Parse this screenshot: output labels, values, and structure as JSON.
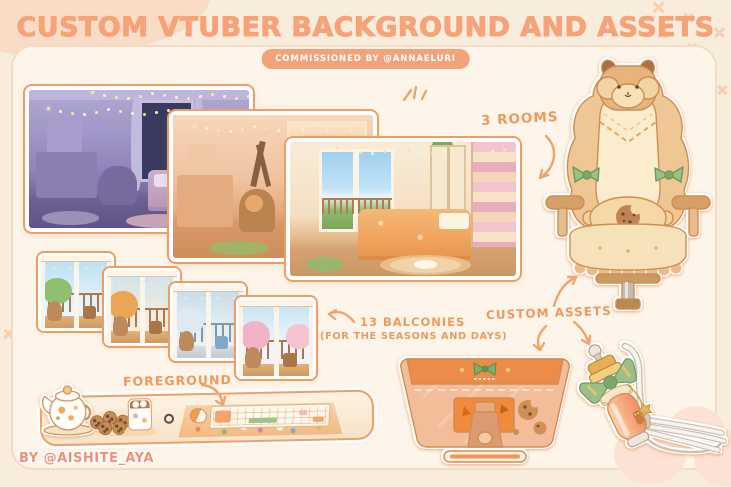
{
  "header": {
    "title": "CUSTOM VTUBER BACKGROUND AND ASSETS",
    "badge": "COMMISSIONED BY @ANNAELURI"
  },
  "labels": {
    "rooms": "3 ROOMS",
    "balconies": "13 BALCONIES",
    "balconies_note": "(FOR THE SEASONS AND DAYS)",
    "custom_assets": "CUSTOM ASSETS",
    "foreground": "FOREGROUND"
  },
  "footer": {
    "credit": "BY @AISHITE_AYA"
  },
  "artworks": {
    "rooms": [
      "night-room-illustration",
      "sunset-room-illustration",
      "day-room-illustration"
    ],
    "balconies": [
      "summer-balcony-illustration",
      "autumn-balcony-illustration",
      "winter-balcony-illustration",
      "spring-balcony-illustration"
    ],
    "assets": [
      "deer-gaming-chair-illustration",
      "monitor-back-illustration",
      "microphone-boom-arm-illustration",
      "desk-foreground-illustration"
    ]
  },
  "colors": {
    "background": "#f8ecdd",
    "panel": "#fdf5ea",
    "panel_border": "#f6dbc4",
    "title_text": "#f7a377",
    "badge_bg": "#f3a379",
    "badge_text": "#ffffff",
    "annotation_text": "#ee9a5e",
    "outline_orange": "#e89a66",
    "bow_green": "#9cbf85",
    "chair_cream": "#faeccd",
    "chair_tan": "#eec795",
    "monitor_band_orange": "#ed8c49",
    "monitor_back": "#f3bd99",
    "night_room_purple": "#9083ba",
    "sunset_room_orange": "#f0c3a0",
    "day_room_cream": "#f5dfc2"
  }
}
